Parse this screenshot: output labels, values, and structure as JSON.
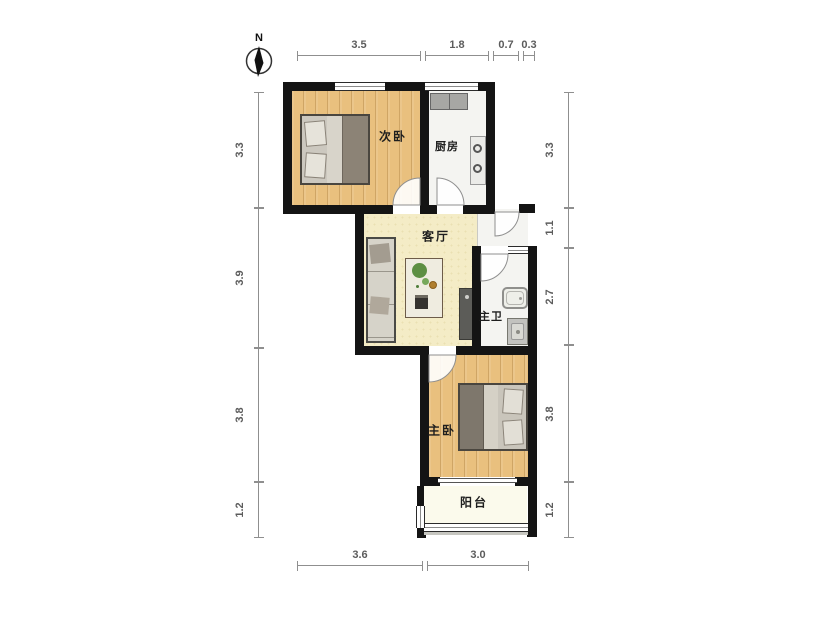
{
  "compass": {
    "label": "N"
  },
  "rooms": {
    "secondary_bedroom": "次卧",
    "kitchen": "厨房",
    "living_room": "客厅",
    "master_bathroom": "主卫",
    "master_bedroom": "主卧",
    "balcony": "阳台"
  },
  "dimensions": {
    "top": [
      "3.5",
      "1.8",
      "0.7",
      "0.3"
    ],
    "left": [
      "3.3",
      "3.9",
      "3.8",
      "1.2"
    ],
    "right": [
      "3.3",
      "1.1",
      "2.7",
      "3.8",
      "1.2"
    ],
    "bottom": [
      "3.6",
      "3.0"
    ]
  },
  "colors": {
    "wall": "#141414",
    "wood_floor": "#e9c07e",
    "living_floor": "#f4ecc6",
    "tile_floor": "#f4f4f1",
    "balcony_floor": "#fbfaec",
    "dimension_line": "#8f8f8f"
  }
}
